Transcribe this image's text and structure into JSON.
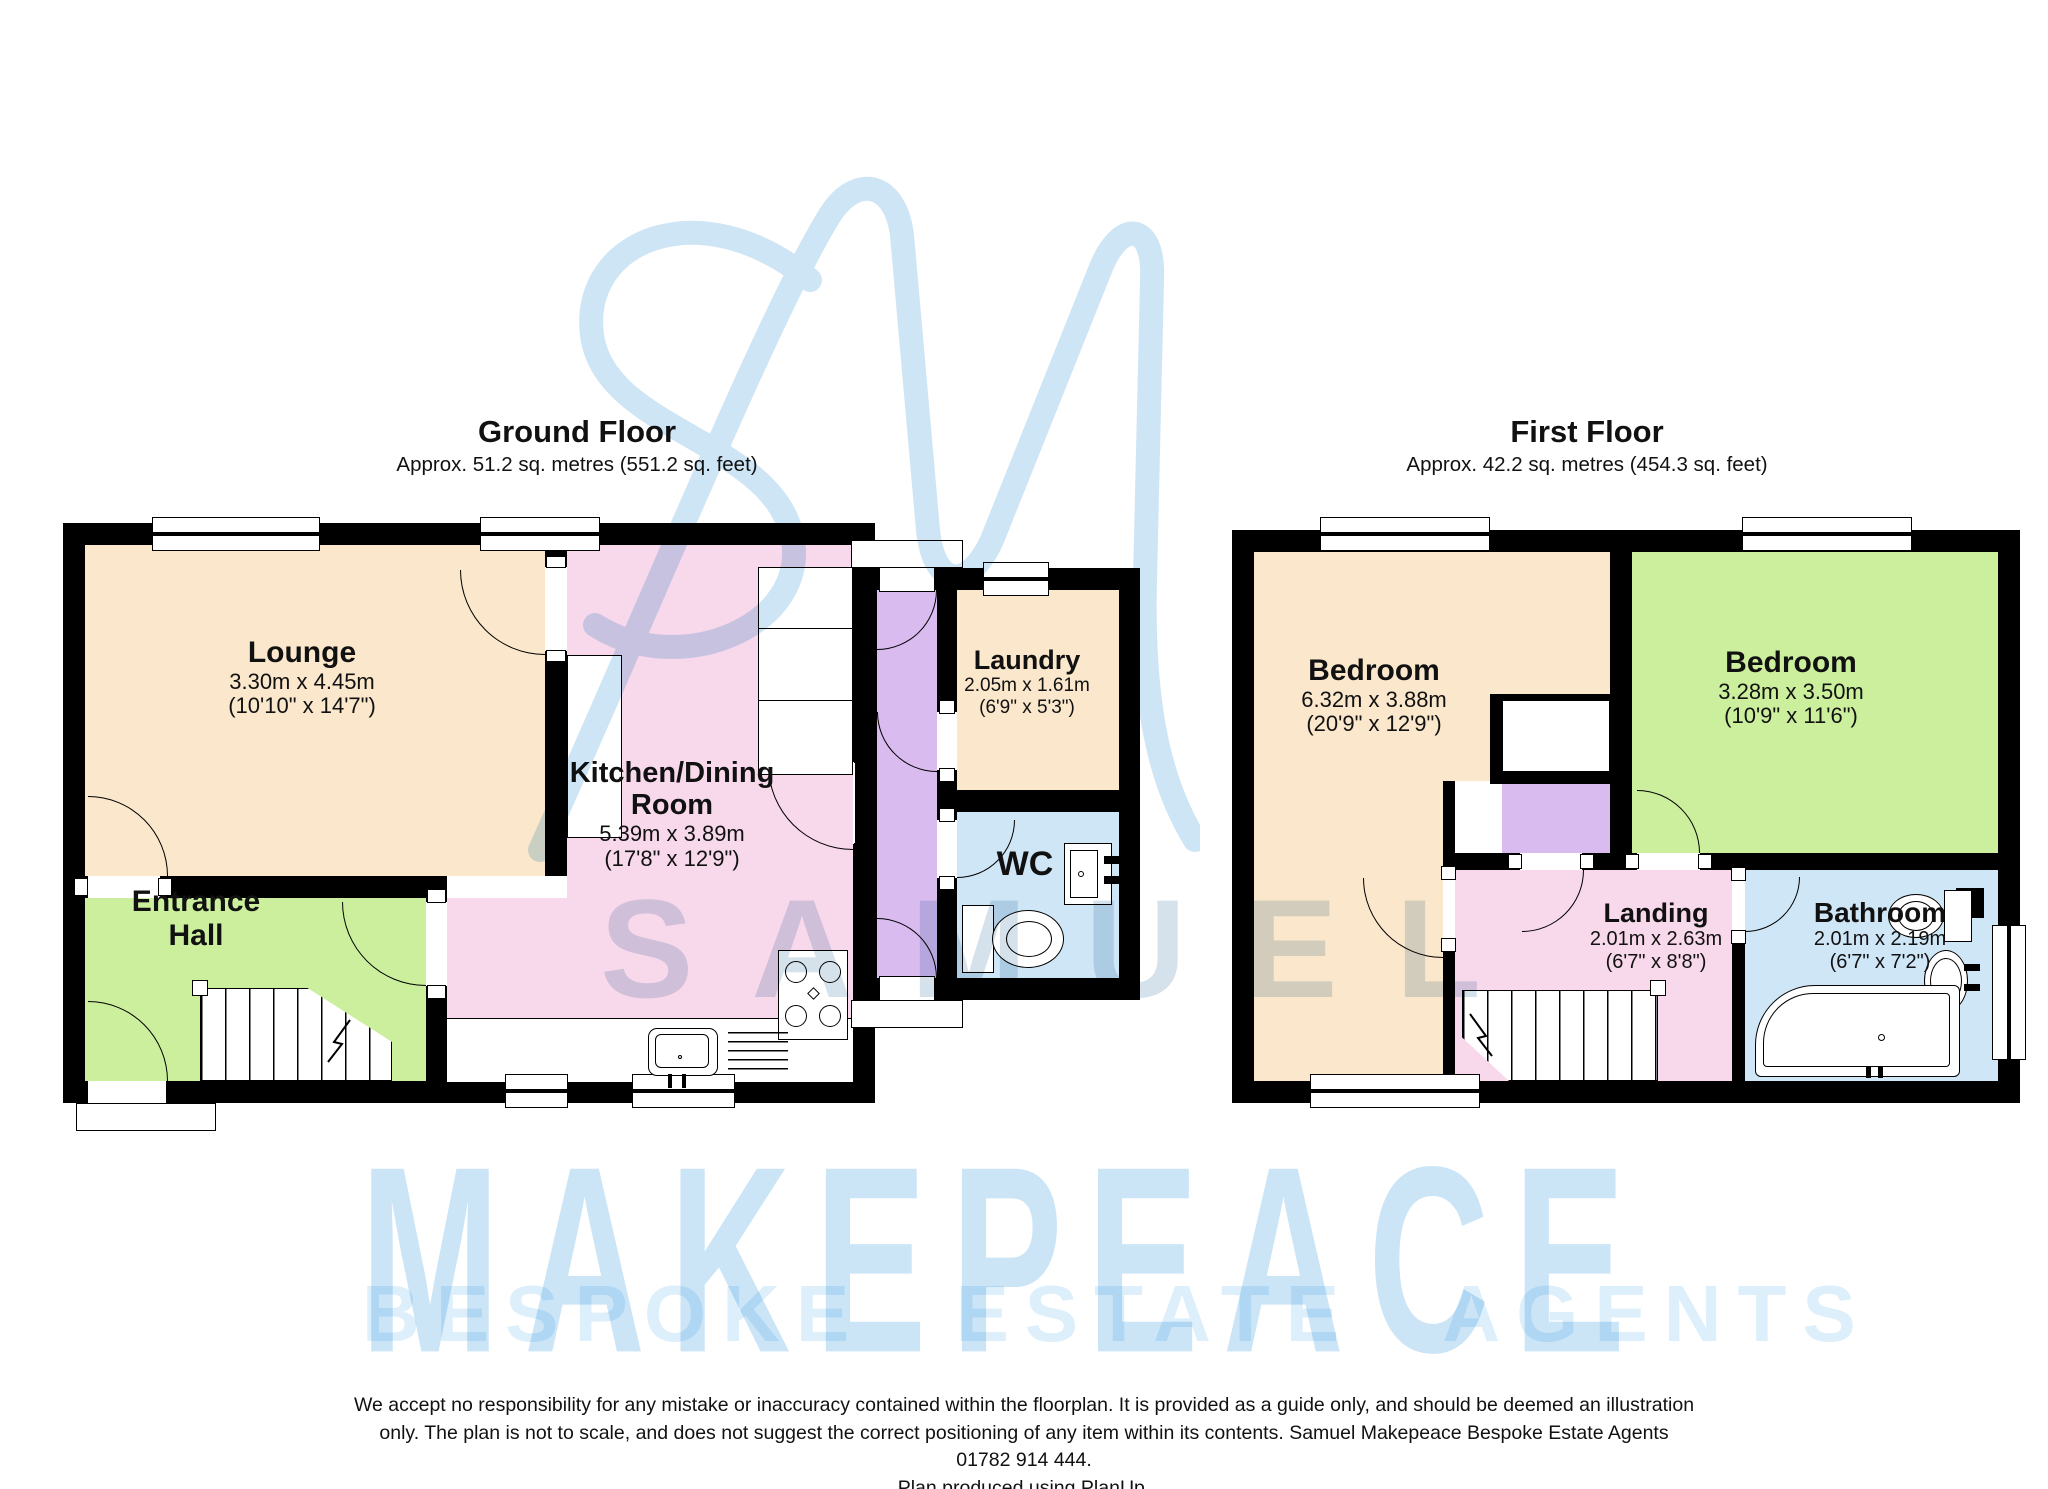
{
  "colors": {
    "wall": "#000000",
    "beige": "#FAE7CC",
    "pink": "#F8D8EB",
    "green": "#CBEF9C",
    "purple": "#D9BBF0",
    "blue": "#CFE6F7",
    "wm_light": "#CBE5F7",
    "wm_lighter": "#DCEFFB",
    "wm_grey": "rgba(145,178,203,0.38)",
    "logo_blue": "#AED3EE"
  },
  "watermark": {
    "monogram": "SM",
    "name": "SAMUEL",
    "brand": "MAKEPEACE",
    "tagline": "BESPOKE ESTATE AGENTS"
  },
  "ground_floor": {
    "title": "Ground Floor",
    "area": "Approx. 51.2 sq. metres (551.2 sq. feet)",
    "rooms": {
      "lounge": {
        "name": "Lounge",
        "metric": "3.30m x 4.45m",
        "imperial": "(10'10\" x 14'7\")"
      },
      "kitchen": {
        "name_line1": "Kitchen/Dining",
        "name_line2": "Room",
        "metric": "5.39m x 3.89m",
        "imperial": "(17'8\" x 12'9\")"
      },
      "entrance_hall": {
        "name_line1": "Entrance",
        "name_line2": "Hall"
      },
      "laundry": {
        "name": "Laundry",
        "metric": "2.05m x 1.61m",
        "imperial": "(6'9\" x 5'3\")"
      },
      "wc": {
        "name": "WC"
      }
    }
  },
  "first_floor": {
    "title": "First Floor",
    "area": "Approx. 42.2 sq. metres (454.3 sq. feet)",
    "rooms": {
      "bedroom1": {
        "name": "Bedroom",
        "metric": "6.32m x 3.88m",
        "imperial": "(20'9\" x 12'9\")"
      },
      "bedroom2": {
        "name": "Bedroom",
        "metric": "3.28m x 3.50m",
        "imperial": "(10'9\" x 11'6\")"
      },
      "landing": {
        "name": "Landing",
        "metric": "2.01m x 2.63m",
        "imperial": "(6'7\" x 8'8\")"
      },
      "bathroom": {
        "name": "Bathroom",
        "metric": "2.01m x 2.19m",
        "imperial": "(6'7\" x 7'2\")"
      }
    }
  },
  "footer": {
    "lines": [
      "We accept no responsibility for any mistake or inaccuracy contained within the floorplan.  It is provided as a guide only, and should be deemed an illustration",
      "only.  The plan is not to scale, and does not suggest the correct positioning of any item within its contents.  Samuel Makepeace Bespoke Estate Agents",
      "01782 914 444.",
      "Plan produced using PlanUp."
    ]
  }
}
